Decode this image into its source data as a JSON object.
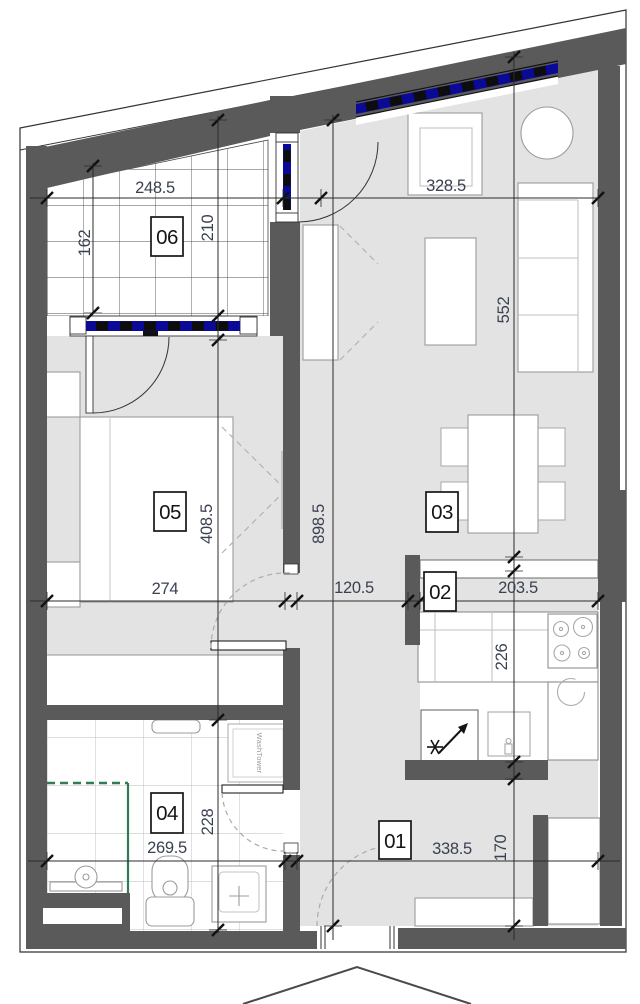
{
  "title": "apartment-floor-plan",
  "rooms": {
    "r01": "01",
    "r02": "02",
    "r03": "03",
    "r04": "04",
    "r05": "05",
    "r06": "06"
  },
  "dims": {
    "d248": "248.5",
    "d162": "162",
    "d210": "210",
    "d328": "328.5",
    "d552": "552",
    "d898": "898.5",
    "d274": "274",
    "d408": "408.5",
    "d120": "120.5",
    "d203": "203.5",
    "d226": "226",
    "d269": "269.5",
    "d228": "228",
    "d338": "338.5",
    "d170": "170"
  },
  "appliances": {
    "washtower": "WashTower"
  },
  "colors": {
    "wall": "#5a5a5a",
    "floor": "#e3e3e3",
    "glazing": "#0a0a96",
    "shower": "#2e7d54",
    "dim_text": "#3a4150"
  }
}
